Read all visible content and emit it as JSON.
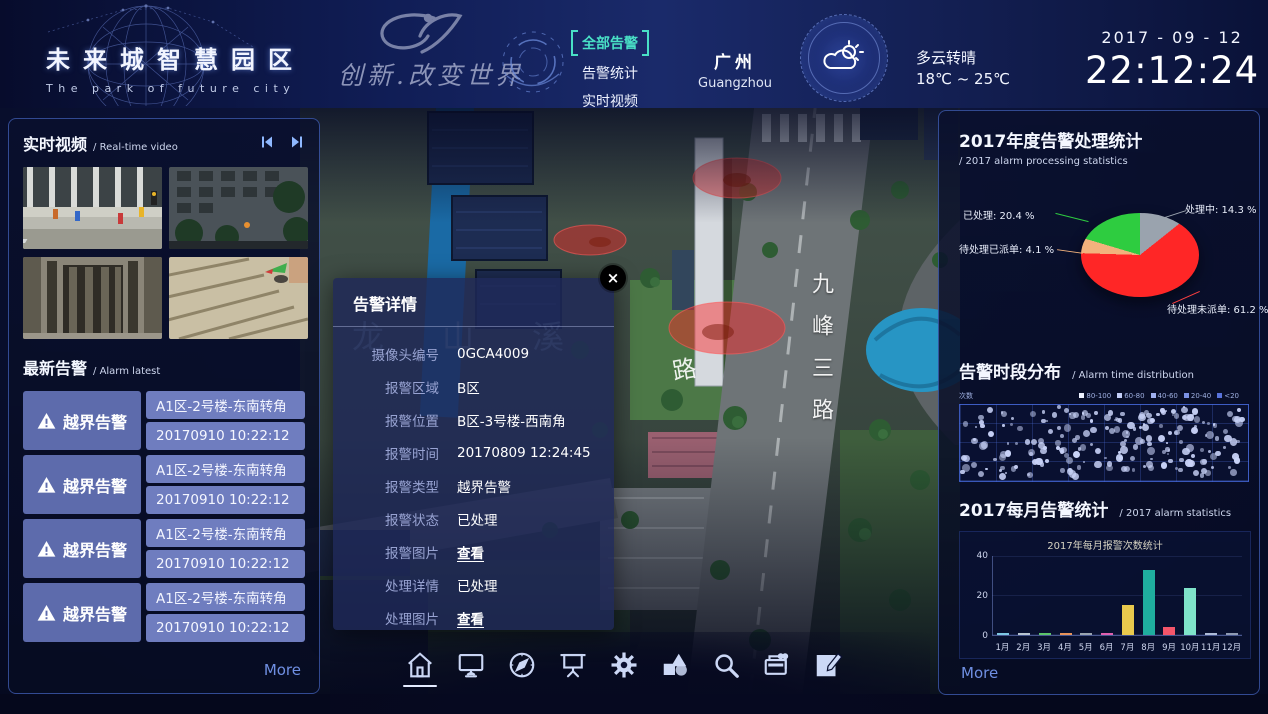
{
  "header": {
    "title": "未来城智慧园区",
    "subtitle": "The park of future city",
    "slogan": "创新.改变世界",
    "menu": [
      {
        "label": "全部告警",
        "active": true
      },
      {
        "label": "告警统计",
        "active": false
      },
      {
        "label": "实时视频",
        "active": false
      }
    ],
    "city_cn": "广州",
    "city_en": "Guangzhou",
    "weather": {
      "condition": "多云转晴",
      "temp": "18℃ ~ 25℃"
    },
    "date": "2017 - 09 - 12",
    "time": "22:12:24"
  },
  "left_panel": {
    "video": {
      "title": "实时视频",
      "subtitle": "/ Real-time video"
    },
    "alarm": {
      "title": "最新告警",
      "subtitle": "/ Alarm latest",
      "items": [
        {
          "type": "越界告警",
          "location": "A1区-2号楼-东南转角",
          "time": "20170910 10:22:12"
        },
        {
          "type": "越界告警",
          "location": "A1区-2号楼-东南转角",
          "time": "20170910 10:22:12"
        },
        {
          "type": "越界告警",
          "location": "A1区-2号楼-东南转角",
          "time": "20170910 10:22:12"
        },
        {
          "type": "越界告警",
          "location": "A1区-2号楼-东南转角",
          "time": "20170910 10:22:12"
        }
      ],
      "more": "More"
    }
  },
  "map": {
    "road_vertical": "九峰三路",
    "road_left": "路",
    "river_name": "龙山溪"
  },
  "modal": {
    "title": "告警详情",
    "close": "×",
    "fields": [
      {
        "label": "摄像头编号",
        "value": "0GCA4009",
        "link": false
      },
      {
        "label": "报警区域",
        "value": "B区",
        "link": false
      },
      {
        "label": "报警位置",
        "value": "B区-3号楼-西南角",
        "link": false
      },
      {
        "label": "报警时间",
        "value": "20170809 12:24:45",
        "link": false
      },
      {
        "label": "报警类型",
        "value": "越界告警",
        "link": false
      },
      {
        "label": "报警状态",
        "value": "已处理",
        "link": false
      },
      {
        "label": "报警图片",
        "value": "查看",
        "link": true
      },
      {
        "label": "处理详情",
        "value": "已处理",
        "link": false
      },
      {
        "label": "处理图片",
        "value": "查看",
        "link": true
      }
    ]
  },
  "right_panel": {
    "more": "More"
  },
  "toolbar": {
    "icons": [
      "home",
      "monitor",
      "compass",
      "screen",
      "settings",
      "shapes",
      "search",
      "records",
      "edit"
    ],
    "active": "home"
  },
  "chart_data": [
    {
      "type": "pie",
      "title": "2017年度告警处理统计",
      "subtitle": "/ 2017 alarm processing statistics",
      "slices": [
        {
          "name": "处理中",
          "value": 14.3,
          "color": "#9aa3ae",
          "label": "处理中: 14.3 %"
        },
        {
          "name": "待处理未派单",
          "value": 61.2,
          "color": "#ff2626",
          "label": "待处理未派单: 61.2 %"
        },
        {
          "name": "待处理已派单",
          "value": 4.1,
          "color": "#f2b27d",
          "label": "待处理已派单: 4.1 %"
        },
        {
          "name": "已处理",
          "value": 20.4,
          "color": "#2ecc40",
          "label": "已处理: 20.4 %"
        }
      ]
    },
    {
      "type": "scatter",
      "title": "告警时段分布",
      "subtitle": "/ Alarm time distribution",
      "axis_label": "次数",
      "legend": [
        "80-100",
        "60-80",
        "40-60",
        "20-40",
        "<20"
      ],
      "legend_colors": [
        "#eef2ff",
        "#c3cef8",
        "#9fb0ef",
        "#7b91e5",
        "#5872da"
      ],
      "point_count": 215,
      "dot_color": "#c9d3f8",
      "x_range": "0-24h grid, 8 columns x 4 rows"
    },
    {
      "type": "bar",
      "panel_title": "2017每月告警统计",
      "panel_subtitle": "/ 2017 alarm statistics",
      "title": "2017年每月报警次数统计",
      "categories": [
        "1月",
        "2月",
        "3月",
        "4月",
        "5月",
        "6月",
        "7月",
        "8月",
        "9月",
        "10月",
        "11月",
        "12月"
      ],
      "values": [
        1,
        1,
        1,
        1,
        1,
        1,
        15,
        33,
        4,
        24,
        1,
        1
      ],
      "colors": [
        "#7ec8e3",
        "#b8c4d0",
        "#5cc46a",
        "#e8935a",
        "#9aa5b1",
        "#e060b0",
        "#e9c94d",
        "#1fae9e",
        "#f4556a",
        "#7fe3c9",
        "#aebcd8",
        "#8f9bb3"
      ],
      "ylim": [
        0,
        40
      ],
      "yticks": [
        0,
        20,
        40
      ]
    }
  ]
}
